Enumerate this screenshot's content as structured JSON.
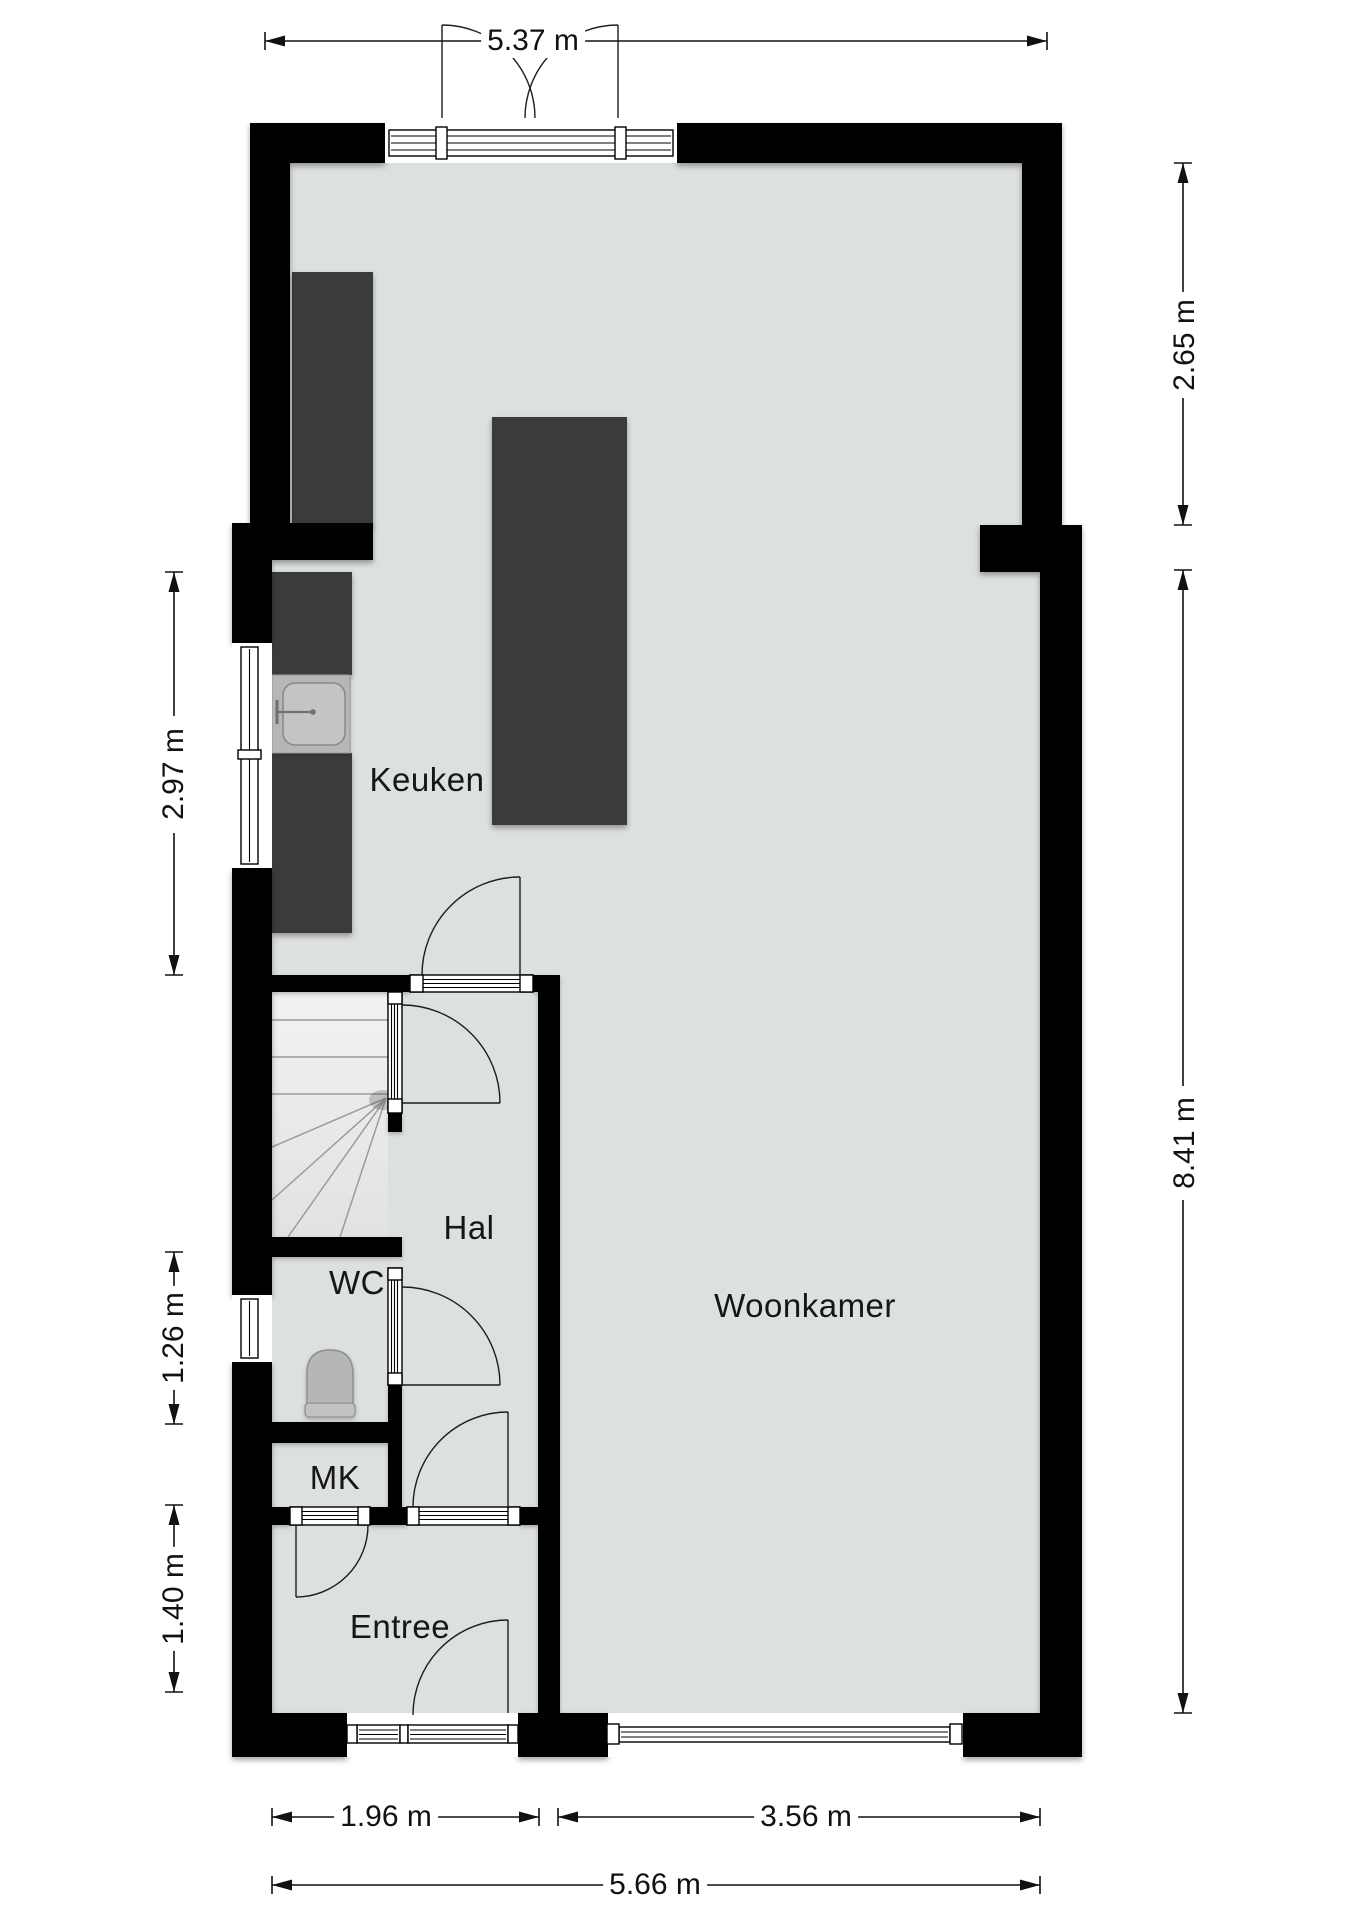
{
  "plan": {
    "title": "floor-plan-ground-floor",
    "rooms": [
      {
        "id": "keuken",
        "label": "Keuken"
      },
      {
        "id": "hal",
        "label": "Hal"
      },
      {
        "id": "wc",
        "label": "WC"
      },
      {
        "id": "mk",
        "label": "MK"
      },
      {
        "id": "entree",
        "label": "Entree"
      },
      {
        "id": "woonkamer",
        "label": "Woonkamer"
      }
    ],
    "dimensions": {
      "top": [
        {
          "label": "5.37 m"
        }
      ],
      "right": [
        {
          "label": "2.65 m"
        },
        {
          "label": "8.41 m"
        }
      ],
      "left": [
        {
          "label": "2.97 m"
        },
        {
          "label": "1.26 m"
        },
        {
          "label": "1.40 m"
        }
      ],
      "bottom": [
        {
          "label": "1.96 m"
        },
        {
          "label": "3.56 m"
        },
        {
          "label": "5.66 m"
        }
      ]
    },
    "fixtures": [
      {
        "name": "kitchen-counter"
      },
      {
        "name": "kitchen-island"
      },
      {
        "name": "kitchen-sink"
      },
      {
        "name": "toilet"
      },
      {
        "name": "stairs-with-winders"
      }
    ],
    "colors": {
      "wall": "#000000",
      "floor": "#dde0e0",
      "counter": "#3a3a3a",
      "fixture_light": "#b6b6b6",
      "stairs": "#eaeaea",
      "background": "#ffffff"
    }
  }
}
